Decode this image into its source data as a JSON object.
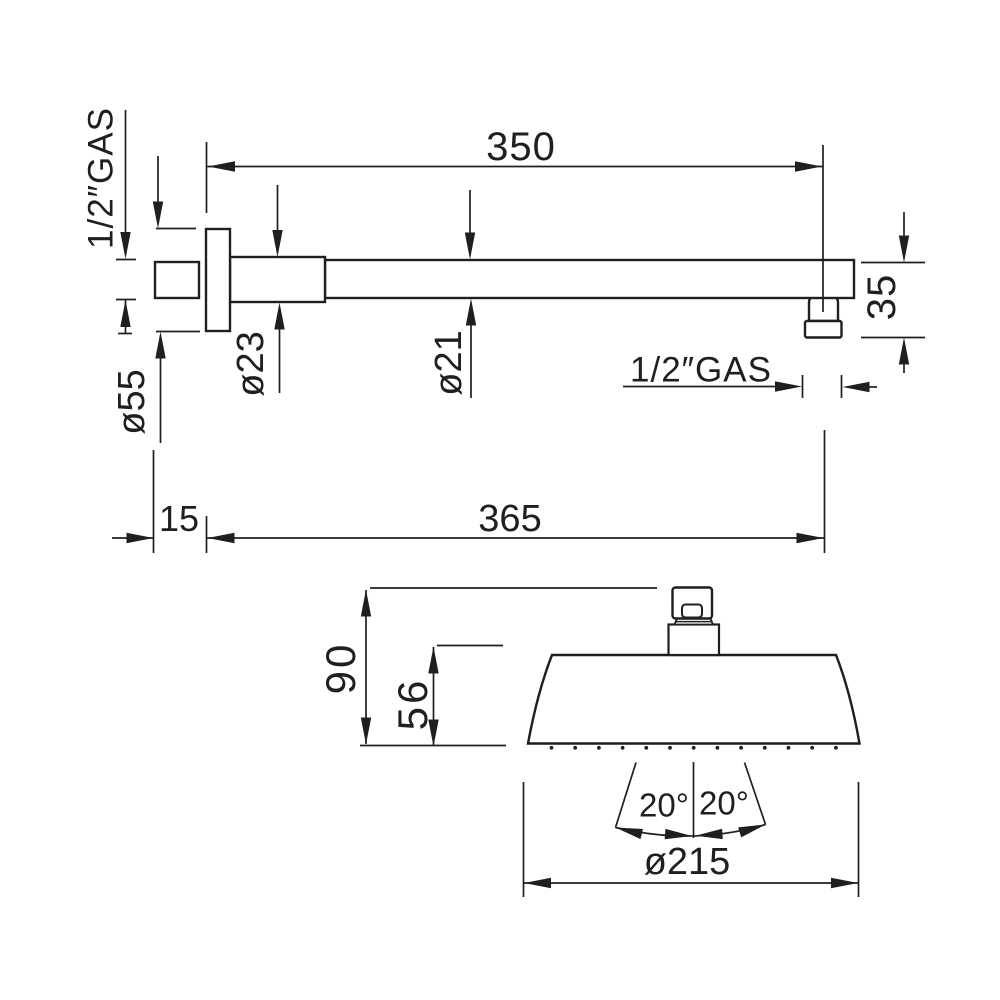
{
  "style": {
    "line_color": "#1f1f1f",
    "background": "#ffffff"
  },
  "top_view": {
    "length_to_outlet": "350",
    "wall_thread": "1/2″GAS",
    "flange_diameter": "ø55",
    "arm_root_diameter": "ø23",
    "arm_diameter": "ø21",
    "outlet_thread": "1/2″GAS",
    "outlet_drop": "35",
    "flange_offset": "15",
    "overall_length": "365"
  },
  "front_view": {
    "overall_height": "90",
    "head_height": "56",
    "spray_angle_left": "20°",
    "spray_angle_right": "20°",
    "head_diameter": "ø215"
  }
}
